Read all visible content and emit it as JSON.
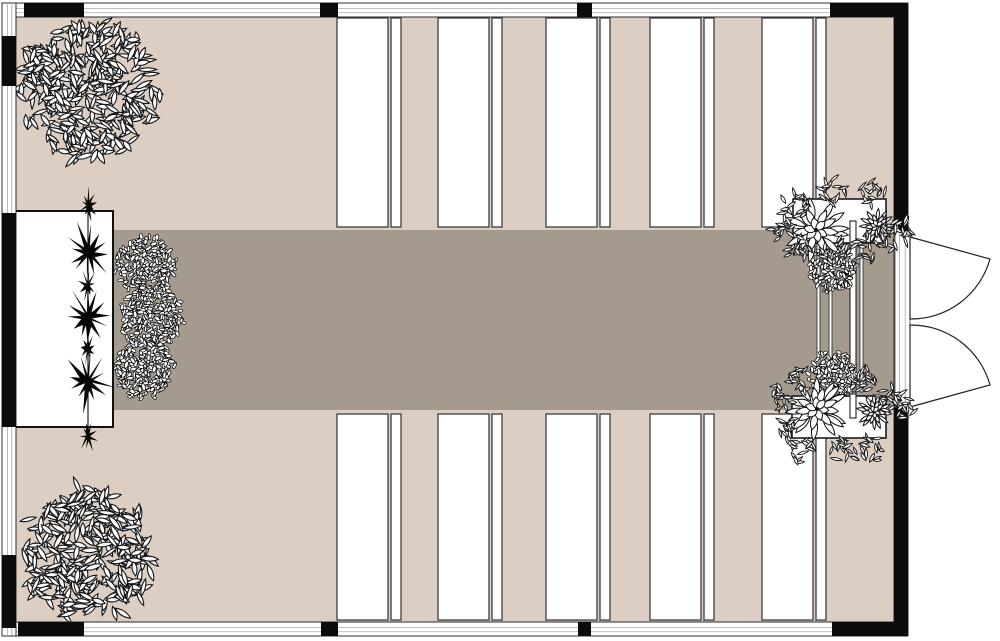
{
  "scene": {
    "w": 1000,
    "h": 641,
    "bg": "#ffffff",
    "kind": "ceremony-floor-plan"
  },
  "colors": {
    "floor": "#dccec2",
    "aisle": "#a49b8e",
    "wall_line": "#2b2b2b",
    "wall_mid": "#9a9a9a",
    "black": "#0b0b0b",
    "bench_stroke": "#3d3d3d",
    "obj_stroke": "#161616",
    "white": "#ffffff"
  },
  "room": {
    "x": 2,
    "y": 3,
    "w": 906,
    "h": 633,
    "t": 14
  },
  "wall_segments": {
    "top": [
      [
        24,
        84
      ],
      [
        320,
        338
      ],
      [
        577,
        592
      ],
      [
        830,
        908
      ]
    ],
    "bottom": [
      [
        18,
        84
      ],
      [
        321,
        338
      ],
      [
        578,
        591
      ],
      [
        832,
        908
      ]
    ],
    "left": [
      [
        36,
        86
      ],
      [
        213,
        427
      ],
      [
        555,
        628
      ]
    ],
    "right": [
      [
        5,
        231
      ],
      [
        407,
        633
      ]
    ]
  },
  "aisle": {
    "x": 113,
    "y": 230,
    "w": 783,
    "h": 180
  },
  "benches": {
    "cols": [
      337,
      438,
      546,
      650,
      762
    ],
    "wide_w": 51,
    "narrow_dx": 54,
    "narrow_w": 10,
    "rows": [
      {
        "y": 18,
        "h": 209
      },
      {
        "y": 414,
        "h": 206
      }
    ]
  },
  "stage": {
    "x": 13,
    "y": 211,
    "w": 100,
    "h": 216,
    "line_x": 88,
    "big_stars": [
      253,
      317,
      381
    ],
    "small_stars": [
      205,
      285,
      349,
      436
    ]
  },
  "trees": [
    {
      "cx": 90,
      "cy": 89,
      "r": 66
    },
    {
      "cx": 89,
      "cy": 553,
      "r": 64
    }
  ],
  "bushes": [
    {
      "cx": 146,
      "cy": 266,
      "r": 29
    },
    {
      "cx": 153,
      "cy": 318,
      "r": 31
    },
    {
      "cx": 144,
      "cy": 368,
      "r": 29
    }
  ],
  "arch_stipples": [
    {
      "cx": 832,
      "cy": 269,
      "r": 23
    },
    {
      "cx": 833,
      "cy": 376,
      "r": 24
    }
  ],
  "arch": {
    "posts_x": [
      817,
      829,
      860
    ],
    "post_w": 3,
    "post_y1": 243,
    "post_y2": 392,
    "pole": {
      "x": 850,
      "w": 6,
      "y1": 221,
      "y2": 418
    }
  },
  "planters": [
    {
      "box": {
        "x": 793,
        "y": 199,
        "w": 93,
        "h": 44
      },
      "flowers": [
        {
          "cx": 816,
          "cy": 230,
          "r": 30
        },
        {
          "cx": 877,
          "cy": 226,
          "r": 16
        }
      ],
      "sprigs": [
        {
          "cx": 783,
          "cy": 226
        },
        {
          "cx": 799,
          "cy": 248
        },
        {
          "cx": 836,
          "cy": 252
        },
        {
          "cx": 866,
          "cy": 248
        },
        {
          "cx": 890,
          "cy": 236
        },
        {
          "cx": 902,
          "cy": 230
        },
        {
          "cx": 871,
          "cy": 194
        },
        {
          "cx": 833,
          "cy": 192
        },
        {
          "cx": 796,
          "cy": 205
        }
      ]
    },
    {
      "box": {
        "x": 792,
        "y": 396,
        "w": 94,
        "h": 42
      },
      "flowers": [
        {
          "cx": 817,
          "cy": 409,
          "r": 29
        },
        {
          "cx": 874,
          "cy": 412,
          "r": 16
        }
      ],
      "sprigs": [
        {
          "cx": 781,
          "cy": 398
        },
        {
          "cx": 800,
          "cy": 381
        },
        {
          "cx": 866,
          "cy": 381
        },
        {
          "cx": 890,
          "cy": 399
        },
        {
          "cx": 903,
          "cy": 408
        },
        {
          "cx": 803,
          "cy": 450
        },
        {
          "cx": 842,
          "cy": 453
        },
        {
          "cx": 874,
          "cy": 448
        },
        {
          "cx": 786,
          "cy": 427
        }
      ]
    }
  ],
  "door": {
    "frame": {
      "x": 895,
      "y": 231,
      "w": 15,
      "h": 176
    },
    "leaves": [
      {
        "hx": 910,
        "hy": 237,
        "r": 82,
        "tip_x": 990,
        "tip_y": 259,
        "end_x": 910,
        "end_y": 319,
        "sweep": 1
      },
      {
        "hx": 910,
        "hy": 407,
        "r": 82,
        "tip_x": 990,
        "tip_y": 385,
        "end_x": 910,
        "end_y": 325,
        "sweep": 0
      }
    ]
  }
}
